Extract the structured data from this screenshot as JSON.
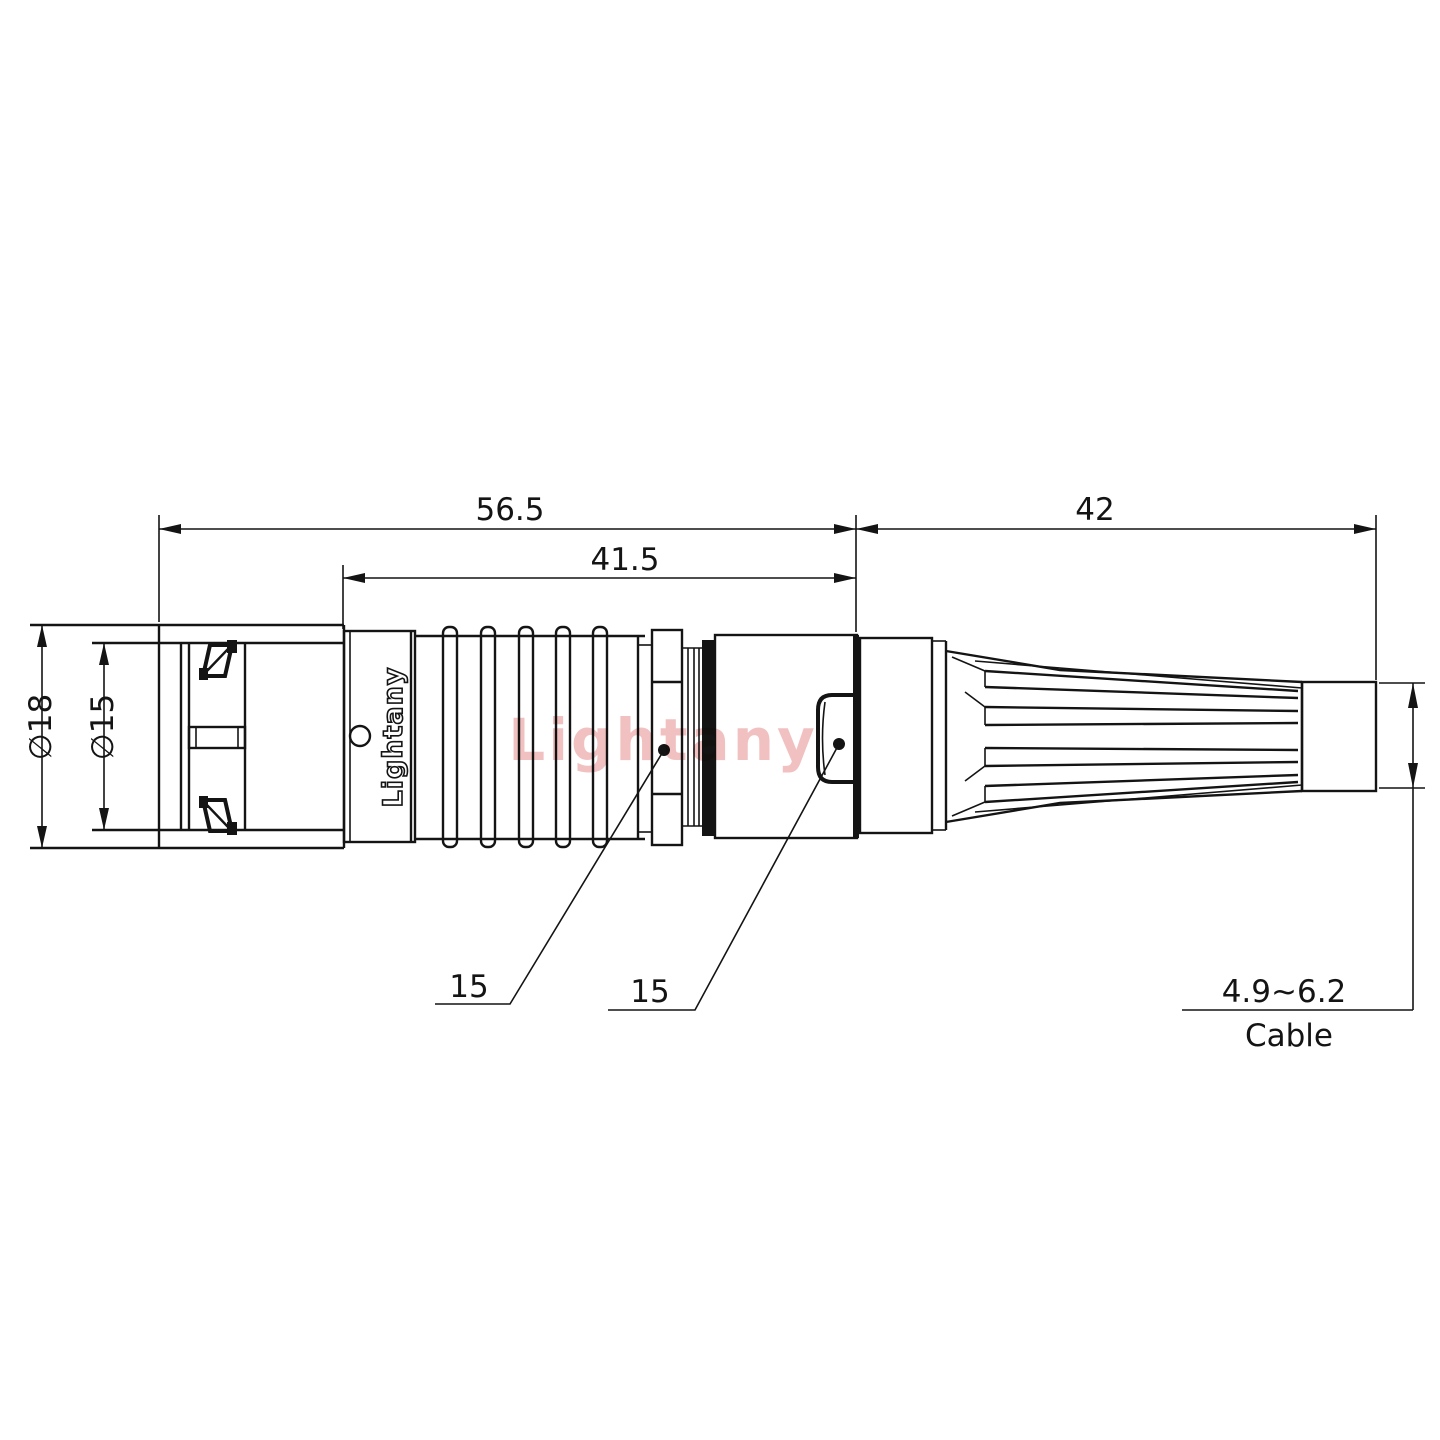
{
  "drawing": {
    "dimensions": {
      "total_length": "56.5",
      "front_section_length": "41.5",
      "boot_length": "42",
      "outer_diameter": "∅18",
      "inner_diameter": "∅15",
      "leader_left": "15",
      "leader_right": "15"
    },
    "cable": {
      "diameter_range": "4.9~6.2",
      "label": "Cable"
    },
    "branding": {
      "logo_text": "Lightany",
      "watermark_text": "Lightany"
    },
    "colors": {
      "line": "#141414",
      "watermark": "#dd6b6b",
      "background": "#ffffff"
    }
  }
}
